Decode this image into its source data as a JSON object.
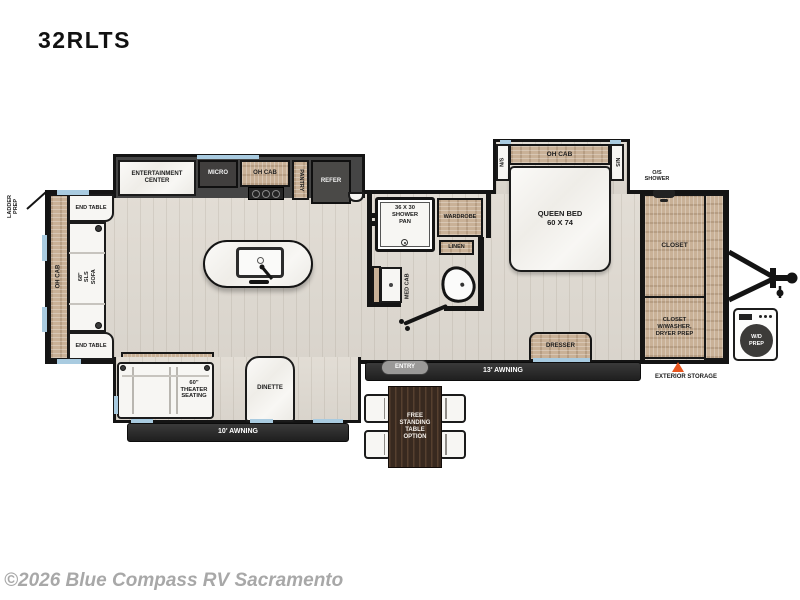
{
  "title": "32RLTS",
  "watermark": "©2026 Blue Compass RV Sacramento",
  "colors": {
    "cabinet_wood": "#c9b197",
    "appliance_dark": "#413f3e",
    "wall": "#141414",
    "floor": "#ddd8d1",
    "window_glass": "#a9cbe0",
    "awning_bar": "#2a2a2a",
    "storage_marker": "#e8541d",
    "furniture_white": "#f7f6f3",
    "watermark_gray": "#a8a8a8"
  },
  "exterior": {
    "ladder_prep": "LADDER\nPREP",
    "os_shower": "O/S\nSHOWER",
    "exterior_storage": "EXTERIOR STORAGE",
    "awning_13": "13' AWNING",
    "awning_10": "10' AWNING",
    "entry": "ENTRY",
    "wd_prep": "W/D\nPREP"
  },
  "rear_living": {
    "oh_cab": "OH CAB",
    "end_table_top": "END TABLE",
    "end_table_bottom": "END TABLE",
    "sofa": "68\"\nSLS\nSOFA",
    "theater": "60\"\nTHEATER\nSEATING",
    "dinette": "DINETTE",
    "table_option": "FREE\nSTANDING\nTABLE\nOPTION"
  },
  "kitchen": {
    "entertainment": "ENTERTAINMENT\nCENTER",
    "micro": "MICRO",
    "oh_cab": "OH CAB",
    "pantry": "PANTRY",
    "refer": "REFER"
  },
  "bath": {
    "shower": "36 X 30\nSHOWER\nPAN",
    "wardrobe": "WARDROBE",
    "linen": "LINEN",
    "med_cab": "MED CAB"
  },
  "bedroom": {
    "oh_cab": "OH CAB",
    "ns_left": "N/S",
    "ns_right": "N/S",
    "bed": "QUEEN BED\n60 X 74",
    "dresser": "DRESSER",
    "closet": "CLOSET",
    "closet_wd": "CLOSET\nW/WASHER,\nDRYER PREP"
  }
}
